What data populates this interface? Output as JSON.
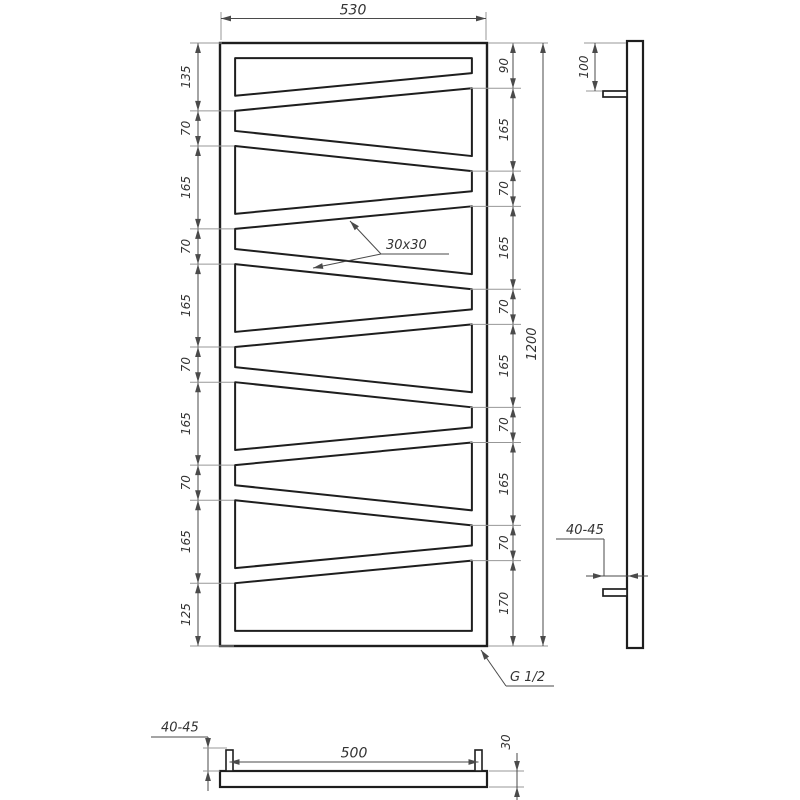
{
  "colors": {
    "object": "#1e1e1e",
    "dim": "#4a4a4a",
    "ext": "#979797",
    "text": "#333333",
    "background": "#ffffff"
  },
  "front_view": {
    "width": "530",
    "height": "1200",
    "left_chain": [
      "135",
      "70",
      "165",
      "70",
      "165",
      "70",
      "165",
      "70",
      "165",
      "125"
    ],
    "right_chain": [
      "90",
      "165",
      "70",
      "165",
      "70",
      "165",
      "70",
      "165",
      "70",
      "170"
    ],
    "tube_section_label": "30x30",
    "thread_label": "G 1/2"
  },
  "side_view": {
    "bracket_offset": "100",
    "wall_clearance": "40-45"
  },
  "bottom_view": {
    "mount_spacing": "500",
    "depth": "30",
    "wall_clearance": "40-45"
  }
}
